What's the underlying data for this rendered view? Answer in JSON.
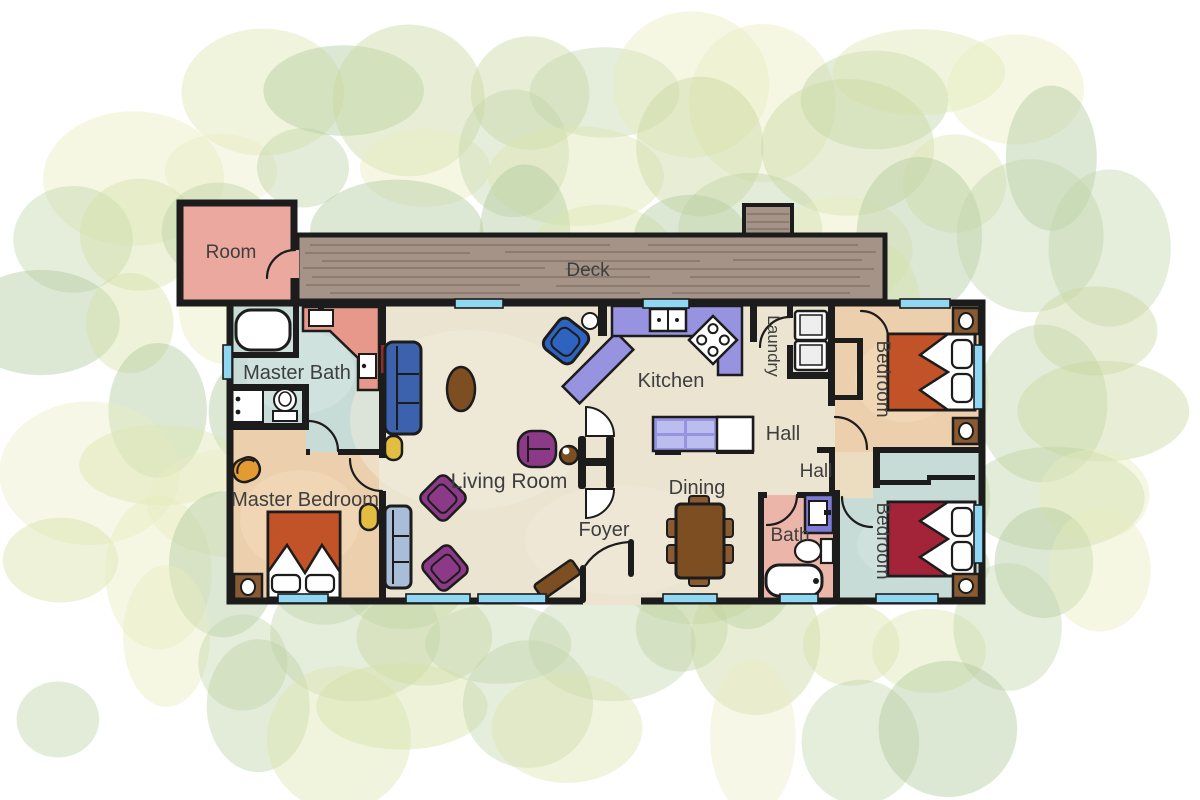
{
  "floorplan": {
    "title": "House floor plan",
    "rooms": [
      {
        "id": "room",
        "label": "Room"
      },
      {
        "id": "deck",
        "label": "Deck"
      },
      {
        "id": "master-bath",
        "label": "Master Bath"
      },
      {
        "id": "master-bedroom",
        "label": "Master Bedroom"
      },
      {
        "id": "living-room",
        "label": "Living Room"
      },
      {
        "id": "foyer",
        "label": "Foyer"
      },
      {
        "id": "kitchen",
        "label": "Kitchen"
      },
      {
        "id": "dining",
        "label": "Dining"
      },
      {
        "id": "laundry",
        "label": "Laundry"
      },
      {
        "id": "hall-upper",
        "label": "Hall"
      },
      {
        "id": "hall-lower",
        "label": "Hall"
      },
      {
        "id": "bath",
        "label": "Bath"
      },
      {
        "id": "bedroom-top-right",
        "label": "Bedroom"
      },
      {
        "id": "bedroom-bottom-right",
        "label": "Bedroom"
      }
    ]
  },
  "palette": {
    "wall": "#1c1c1c",
    "floor-beige": "#ebe4d1",
    "floor-peach": "#ecd0ae",
    "floor-teal": "#c7dbd7",
    "corridor-tan": "#ecdcc0",
    "room-pink": "#eaa89e",
    "bath-pink": "#ecb5aa",
    "deck-wood": "#a59387",
    "deck-line": "#7c6c60",
    "counter-purple": "#9793e0",
    "counter-light": "#babdee",
    "vanity-purple": "#7e7bd8",
    "vanity-salmon": "#e8978b",
    "window-blue": "#8fd7f2",
    "wood-brown": "#7c4e22",
    "wood-warm": "#8a5a32",
    "sofa-blue": "#3c62ae",
    "armchair-blue": "#2f63c0",
    "couch-blue": "#a9bdd9",
    "chair-purple": "#8c3a88",
    "chair-yellow": "#e3bc42",
    "chair-orange": "#e29b33",
    "bed-orange": "#c25227",
    "bed-maroon": "#a32338",
    "label-gray": "#3e3e3e",
    "fixture-white": "#ffffff"
  },
  "foliage_colors": [
    "#c9d79d",
    "#dce5ae",
    "#bdd2a2",
    "#e6ecbd",
    "#d3e0a4",
    "#c2d5a9",
    "#e9ecc3",
    "#afc898"
  ]
}
